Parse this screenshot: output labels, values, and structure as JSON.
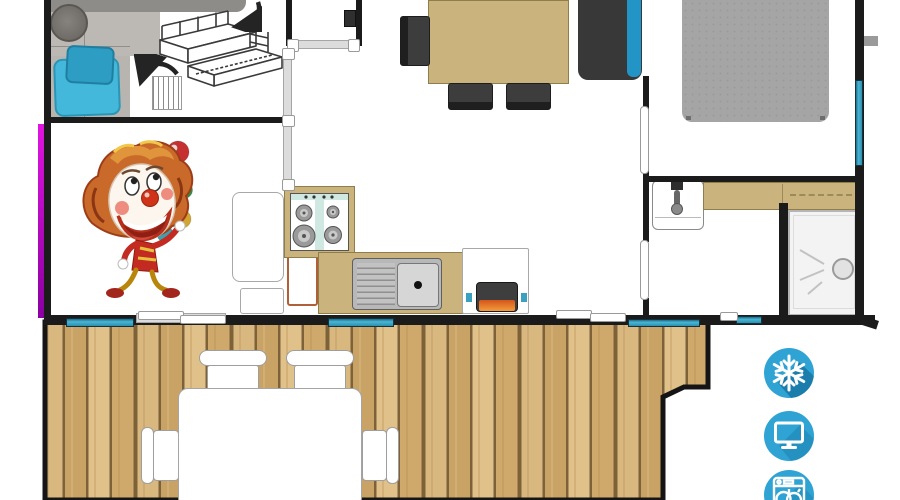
{
  "meta": {
    "type": "floor-plan",
    "subject": "mobile-home-layout-with-terrace"
  },
  "amenities": {
    "items": [
      {
        "name": "air-conditioning",
        "icon": "snowflake-icon"
      },
      {
        "name": "tv",
        "icon": "tv-icon"
      },
      {
        "name": "dishwasher",
        "icon": "dishwasher-icon"
      }
    ]
  },
  "rooms": [
    {
      "name": "bedroom-bunk",
      "furniture": [
        "single-bed-top-view",
        "blue-cushions",
        "stool",
        "radiator",
        "bunk-bed-sketch",
        "fold-arrows"
      ]
    },
    {
      "name": "living-dining",
      "furniture": [
        "dining-table",
        "dining-chairs",
        "sofa-with-blue-cushion",
        "wall-tv"
      ]
    },
    {
      "name": "bedroom-double",
      "furniture": [
        "double-bed"
      ]
    },
    {
      "name": "kitchen",
      "furniture": [
        "gas-hob",
        "sink-with-drainer",
        "worktop",
        "cabinets",
        "heater"
      ]
    },
    {
      "name": "shower-room",
      "furniture": [
        "washbasin",
        "vanity-counter",
        "shower-cabin"
      ]
    },
    {
      "name": "terrace",
      "furniture": [
        "outdoor-table",
        "outdoor-chairs",
        "wood-decking"
      ]
    }
  ],
  "mascot": {
    "name": "juggling-clown-illustration"
  },
  "colors": {
    "wall": "#1b1b1b",
    "accent_magenta": "#cc00cc",
    "window_teal": "#2b8fb0",
    "counter_tan": "#cab37d",
    "cushion_blue": "#43b8da",
    "sofa_blue": "#2394c6",
    "bed_gray": "#a5a5a5",
    "wood_light": "#d9b87f",
    "wood_dark": "#c9a265",
    "icon_blue": "#2ea3d4",
    "icon_shadow": "#1b7dab"
  }
}
